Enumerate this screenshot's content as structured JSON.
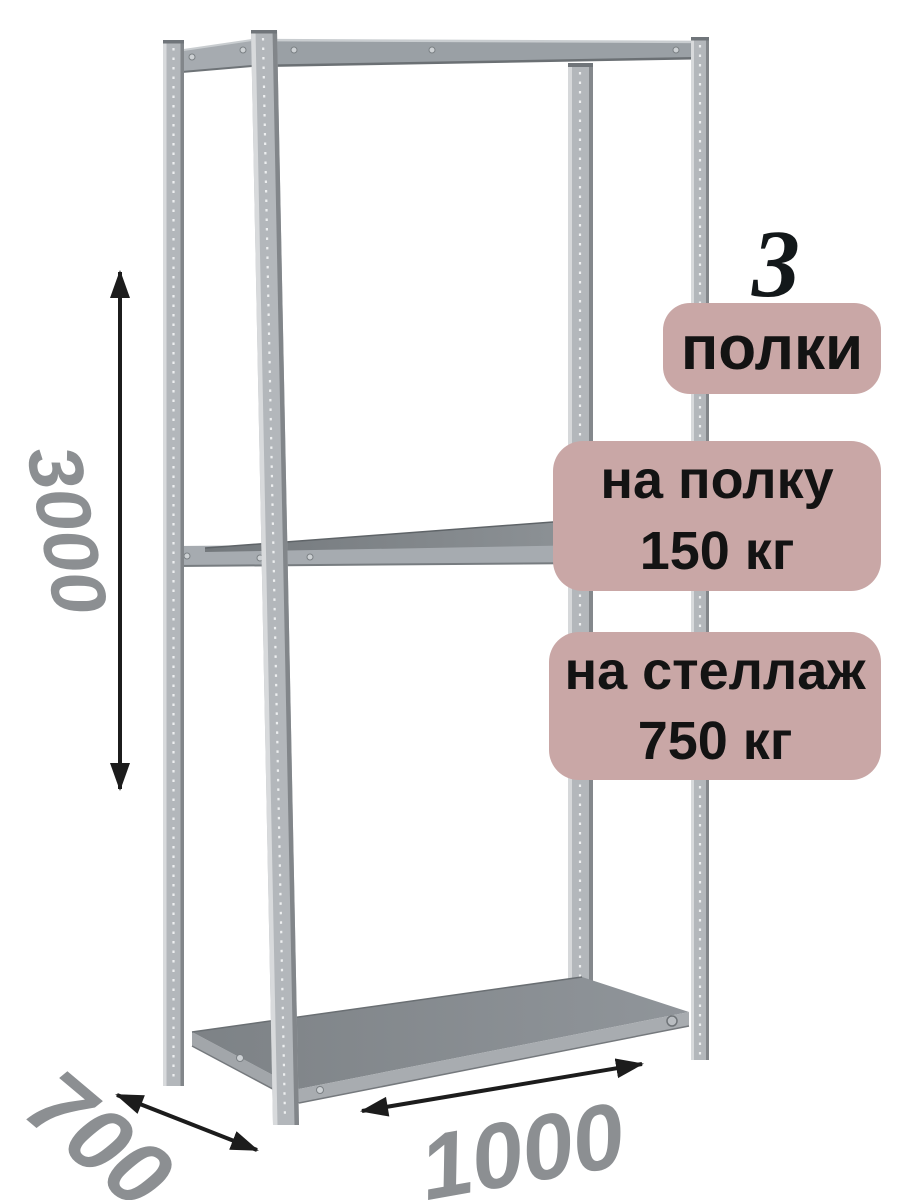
{
  "annotations": {
    "shelf_count_number": "3",
    "shelf_count_unit": "полки",
    "per_shelf_line1": "на полку",
    "per_shelf_line2": "150 кг",
    "per_rack_line1": "на стеллаж",
    "per_rack_line2": "750 кг"
  },
  "dimensions": {
    "height_mm": "3000",
    "depth_mm": "700",
    "width_mm": "1000"
  },
  "colors": {
    "badge_background": "#c9a7a6",
    "badge_text": "#131313",
    "dimension_text": "#8c8f92",
    "arrow": "#1c1c1c",
    "rack_metal_light": "#b3b7bb",
    "rack_shelf_dark": "#7e8387",
    "background": "#ffffff"
  }
}
